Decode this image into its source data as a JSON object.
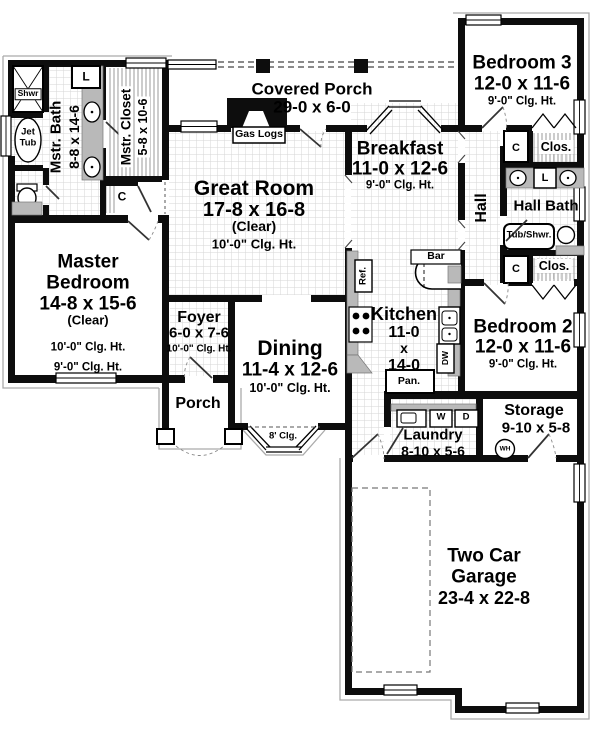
{
  "rooms": {
    "covered_porch": {
      "name": "Covered Porch",
      "dims": "29-0 x 6-0"
    },
    "great_room": {
      "name": "Great Room",
      "dims": "17-8 x 16-8",
      "note": "(Clear)",
      "ceiling": "10'-0\" Clg. Ht."
    },
    "breakfast": {
      "name": "Breakfast",
      "dims": "11-0 x 12-6",
      "ceiling": "9'-0\" Clg. Ht."
    },
    "bedroom3": {
      "name": "Bedroom 3",
      "dims": "12-0 x 11-6",
      "ceiling": "9'-0\" Clg. Ht."
    },
    "master_bath": {
      "name": "Mstr. Bath",
      "dims": "8-8 x 14-6"
    },
    "master_closet": {
      "name": "Mstr. Closet",
      "dims": "5-8 x 10-6"
    },
    "master_bedroom": {
      "name_line1": "Master",
      "name_line2": "Bedroom",
      "dims": "14-8 x 15-6",
      "note": "(Clear)",
      "ceiling": "10'-0\" Clg. Ht.",
      "ceiling_outer": "9'-0\" Clg. Ht."
    },
    "foyer": {
      "name": "Foyer",
      "dims": "6-0 x 7-6",
      "ceiling": "10'-0\" Clg. Ht."
    },
    "dining": {
      "name": "Dining",
      "dims": "11-4 x 12-6",
      "ceiling": "10'-0\" Clg. Ht.",
      "bay_ceiling": "8' Clg."
    },
    "kitchen": {
      "name": "Kitchen",
      "dim_line1": "11-0",
      "dim_line2": "x",
      "dim_line3": "14-0"
    },
    "hall": {
      "name": "Hall"
    },
    "hall_bath": {
      "name": "Hall Bath"
    },
    "bedroom2": {
      "name": "Bedroom 2",
      "dims": "12-0 x 11-6",
      "ceiling": "9'-0\" Clg. Ht."
    },
    "laundry": {
      "name": "Laundry",
      "dims": "8-10 x 5-6"
    },
    "storage": {
      "name": "Storage",
      "dims": "9-10 x 5-8"
    },
    "porch": {
      "name": "Porch"
    },
    "garage": {
      "name_line1": "Two Car",
      "name_line2": "Garage",
      "dims": "23-4 x 22-8"
    }
  },
  "fixtures": {
    "shower": "Shwr",
    "jet_tub_line1": "Jet",
    "jet_tub_line2": "Tub",
    "linen": "L",
    "closet_small": "C",
    "closet": "Clos.",
    "gas_logs": "Gas Logs",
    "bar": "Bar",
    "refrigerator": "Ref.",
    "dishwasher": "DW",
    "pantry": "Pan.",
    "washer": "W",
    "dryer": "D",
    "water_heater": "WH",
    "tub_shower": "Tub/Shwr."
  },
  "colors": {
    "wall": "#0d0d0d",
    "counter": "#b9b9b9",
    "tile_line": "#d6d6d6"
  }
}
